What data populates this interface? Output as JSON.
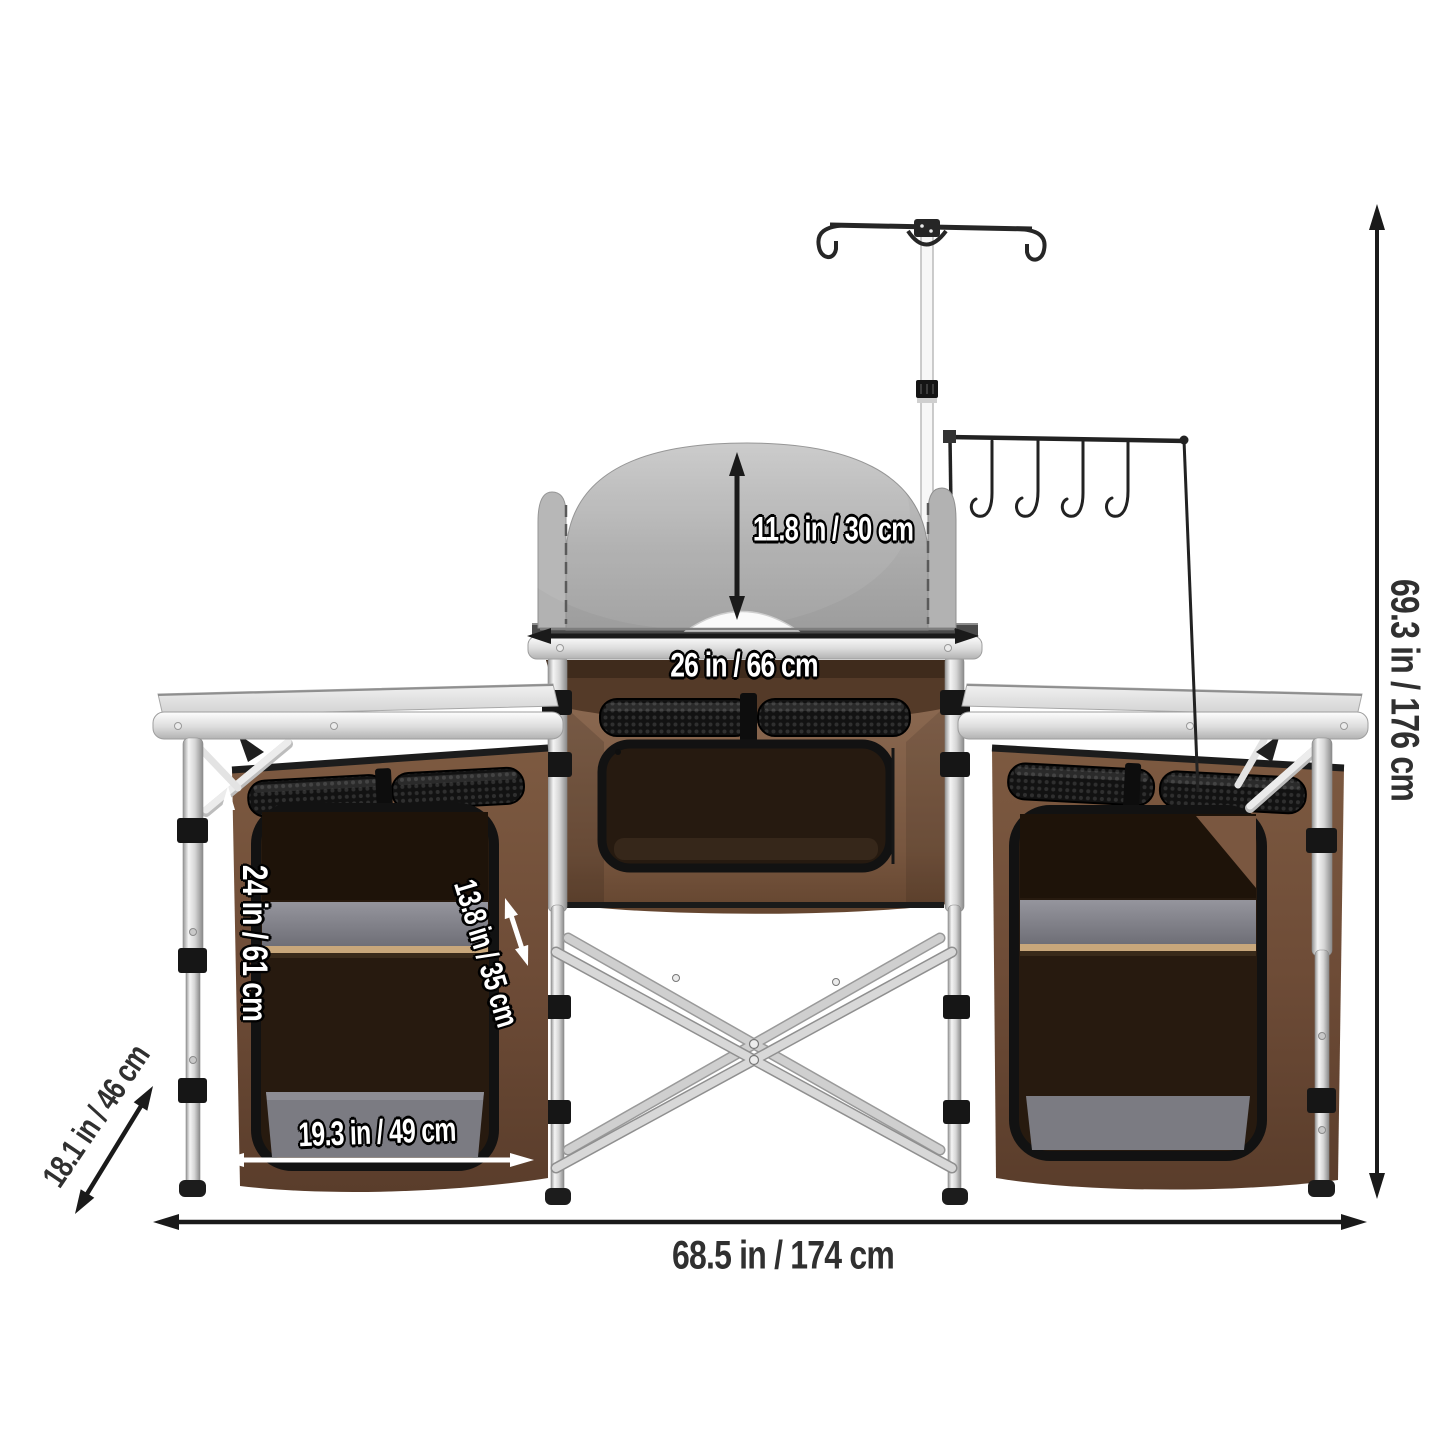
{
  "product": {
    "name": "camping-kitchen-dimension-diagram"
  },
  "labels": {
    "windscreen_height": "11.8 in / 30 cm",
    "center_table_width": "26 in / 66 cm",
    "total_height": "69.3 in / 176 cm",
    "cabinet_height": "24 in / 61 cm",
    "shelf_diagonal": "13.8 in / 35 cm",
    "cabinet_width": "19.3 in / 49 cm",
    "depth": "18.1 in / 46 cm",
    "total_width": "68.5 in / 174 cm"
  },
  "colors": {
    "background": "#ffffff",
    "fabric_brown": "#6e4c37",
    "fabric_dark_interior": "#271a0f",
    "shelf_gray": "#84848c",
    "shelf_edge_tan": "#c8a77b",
    "windscreen_gray": "#adadad",
    "aluminum": "#d9d9d9",
    "arrow_black": "#1a1a1a",
    "arrow_white": "#ffffff",
    "label_dark": "#303030",
    "label_white": "#ffffff"
  }
}
